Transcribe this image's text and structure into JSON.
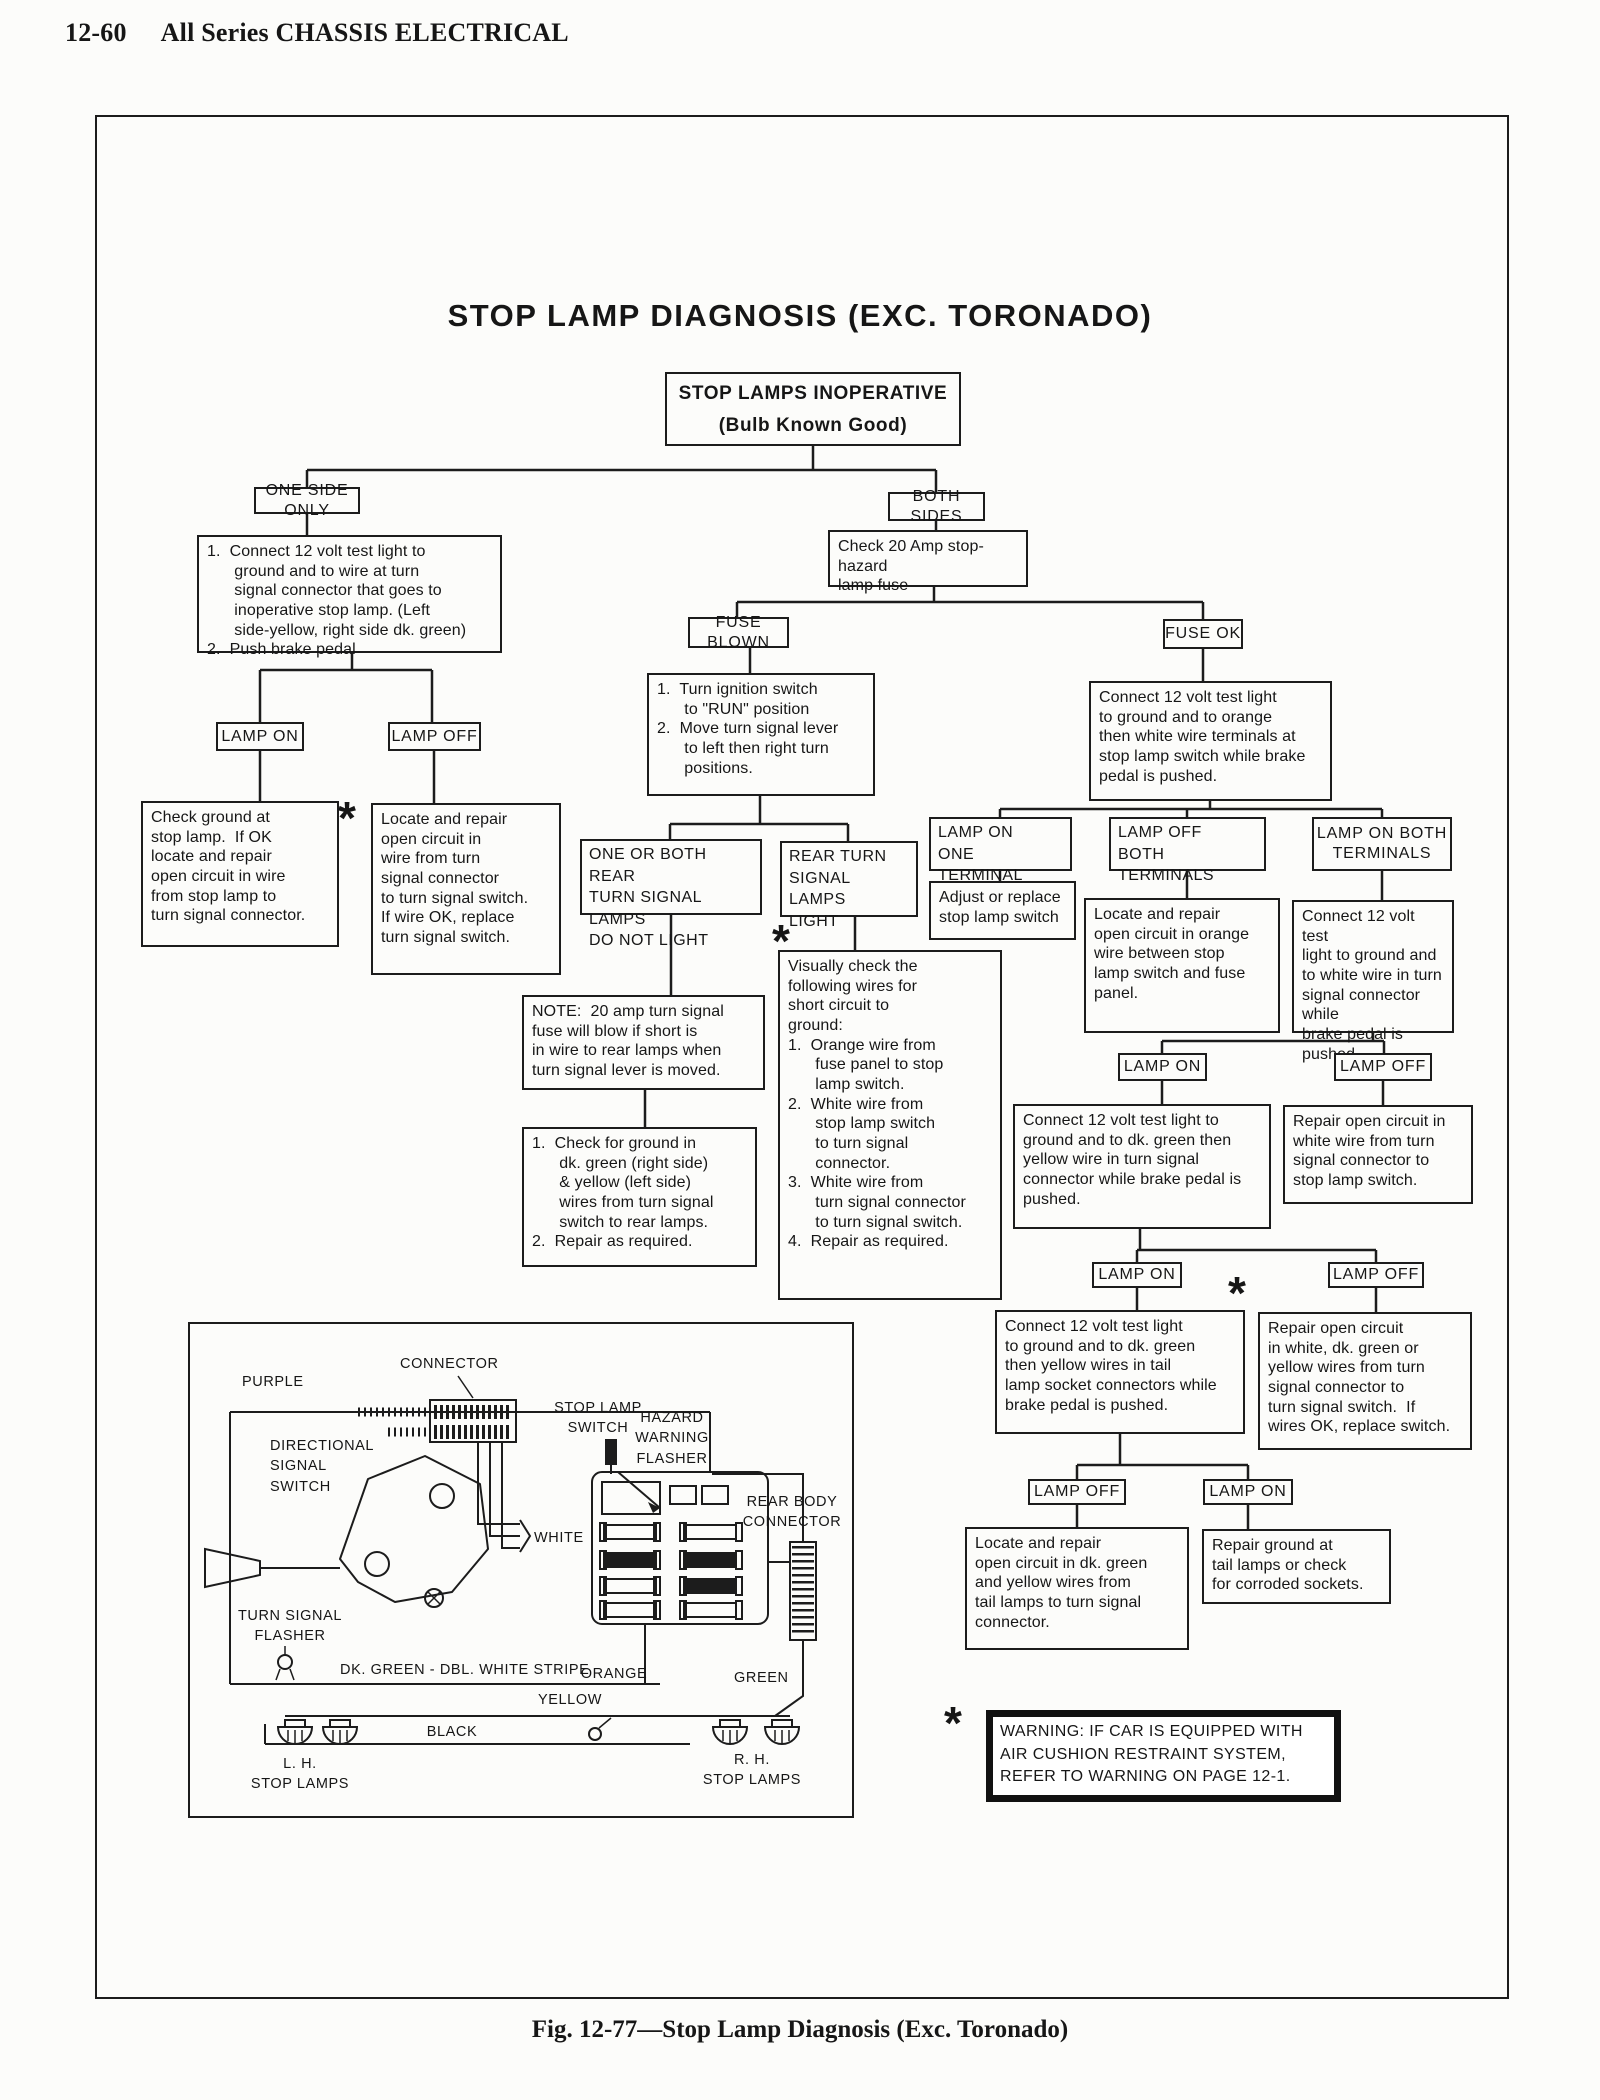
{
  "page": {
    "page_number": "12-60",
    "section_title": "All Series CHASSIS ELECTRICAL",
    "figure_caption": "Fig. 12-77—Stop Lamp Diagnosis (Exc. Toronado)"
  },
  "flowchart": {
    "title": "STOP LAMP DIAGNOSIS (EXC. TORONADO)",
    "footnote_marker": "*",
    "nodes": {
      "root": "STOP LAMPS INOPERATIVE\n(Bulb Known Good)",
      "one_side_only": "ONE SIDE ONLY",
      "both_sides": "BOTH SIDES",
      "one_side_steps": "1.  Connect 12 volt test light to\n      ground and to wire at turn\n      signal connector that goes to\n      inoperative stop lamp. (Left\n      side-yellow, right side dk. green)\n2.  Push brake pedal",
      "check_fuse": "Check 20 Amp stop-hazard\nlamp fuse",
      "lamp_on_left": "LAMP ON",
      "lamp_off_left": "LAMP OFF",
      "check_ground": "Check ground at\nstop lamp.  If OK\nlocate and repair\nopen circuit in wire\nfrom stop lamp to\nturn signal connector.",
      "locate_open_left": "Locate and repair\nopen circuit in\nwire from turn\nsignal connector\nto turn signal switch.\nIf wire OK, replace\nturn signal switch.",
      "fuse_blown": "FUSE BLOWN",
      "fuse_ok": "FUSE OK",
      "ignition_steps": "1.  Turn ignition switch\n      to \"RUN\" position\n2.  Move turn signal lever\n      to left then right turn\n      positions.",
      "one_or_both": "ONE OR BOTH REAR\nTURN SIGNAL LAMPS\nDO NOT LIGHT",
      "rear_turn_light": "REAR TURN\nSIGNAL LAMPS\nLIGHT",
      "note": "NOTE:  20 amp turn signal\nfuse will blow if short is\nin wire to rear lamps when\nturn signal lever is moved.",
      "check_for_ground": "1.  Check for ground in\n      dk. green (right side)\n      & yellow (left side)\n      wires from turn signal\n      switch to rear lamps.\n2.  Repair as required.",
      "visually_check": "Visually check the\nfollowing wires for\nshort circuit to\nground:\n1.  Orange wire from\n      fuse panel to stop\n      lamp switch.\n2.  White wire from\n      stop lamp switch\n      to turn signal\n      connector.\n3.  White wire from\n      turn signal connector\n      to turn signal switch.\n4.  Repair as required.",
      "connect_orange_white": "Connect 12 volt test light\nto ground and to orange\nthen white wire terminals at\nstop lamp switch while brake\npedal is pushed.",
      "lamp_on_one_terminal": "LAMP ON\nONE TERMINAL",
      "lamp_off_both_terminals": "LAMP OFF\nBOTH TERMINALS",
      "lamp_on_both_terminals": "LAMP ON BOTH\nTERMINALS",
      "adjust_replace": "Adjust or replace\nstop lamp switch",
      "locate_orange": "Locate and repair\nopen circuit in orange\nwire between stop\nlamp switch and fuse\npanel.",
      "connect_white_turn": "Connect 12 volt test\nlight to ground and\nto white wire in turn\nsignal connector while\nbrake pedal is pushed.",
      "lamp_on_r1": "LAMP ON",
      "lamp_off_r1": "LAMP OFF",
      "connect_dk_green": "Connect 12 volt test light to\nground and to dk. green then\nyellow wire in turn signal\nconnector while brake pedal is\npushed.",
      "repair_white": "Repair open circuit in\nwhite wire from turn\nsignal connector to\nstop lamp switch.",
      "lamp_on_r2": "LAMP ON",
      "lamp_off_r2": "LAMP OFF",
      "connect_tail": "Connect 12 volt test light\nto ground and to dk. green\nthen yellow wires in tail\nlamp socket connectors while\nbrake pedal is pushed.",
      "repair_open_star": "Repair open circuit\nin white, dk. green or\nyellow wires from turn\nsignal connector to\nturn signal switch.  If\nwires OK, replace switch.",
      "lamp_off_bottom": "LAMP OFF",
      "lamp_on_bottom": "LAMP ON",
      "locate_tail": "Locate and repair\nopen circuit in dk. green\nand yellow wires from\ntail lamps to turn signal\nconnector.",
      "repair_ground": "Repair ground at\ntail lamps or check\nfor corroded sockets."
    }
  },
  "warning": {
    "text": "WARNING:  IF CAR IS EQUIPPED WITH\nAIR CUSHION RESTRAINT SYSTEM,\nREFER TO WARNING ON PAGE 12-1."
  },
  "wiring_diagram": {
    "labels": {
      "purple": "PURPLE",
      "connector": "CONNECTOR",
      "stop_lamp_switch": "STOP LAMP\nSWITCH",
      "hazard_warning_flasher": "HAZARD\nWARNING\nFLASHER",
      "directional_signal_switch": "DIRECTIONAL\nSIGNAL\nSWITCH",
      "white": "WHITE",
      "rear_body_connector": "REAR BODY\nCONNECTOR",
      "turn_signal_flasher": "TURN SIGNAL\nFLASHER",
      "dk_green_stripe": "DK. GREEN - DBL. WHITE STRIPE",
      "orange": "ORANGE",
      "green": "GREEN",
      "yellow": "YELLOW",
      "black": "BLACK",
      "lh_stop_lamps": "L. H.\nSTOP LAMPS",
      "rh_stop_lamps": "R. H.\nSTOP LAMPS"
    }
  }
}
